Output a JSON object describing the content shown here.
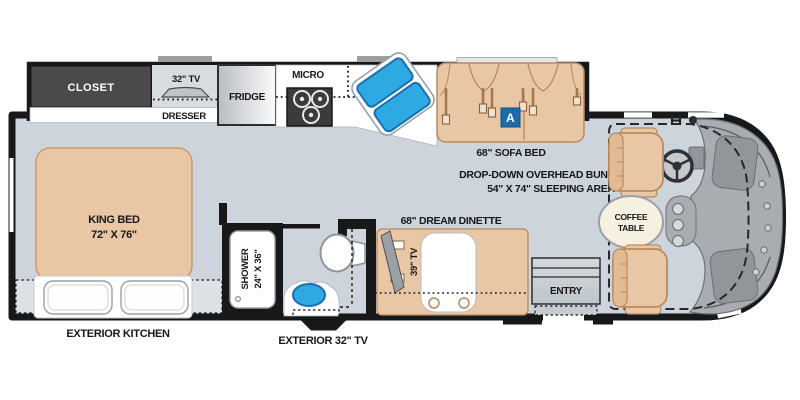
{
  "floorplan": {
    "labels": {
      "closet": "CLOSET",
      "tv32": "32\" TV",
      "dresser": "DRESSER",
      "fridge": "FRIDGE",
      "micro": "MICRO",
      "sofa_bed": "68\" SOFA BED",
      "sofa_badge": "A",
      "bunk_line1": "DROP-DOWN OVERHEAD BUNK",
      "bunk_line2": "54\" X 74\" SLEEPING AREA",
      "king_bed_line1": "KING BED",
      "king_bed_line2": "72\" X 76\"",
      "shower_line1": "SHOWER",
      "shower_line2": "24\" X 36\"",
      "tv39": "39\" TV",
      "dinette": "68\" DREAM DINETTE",
      "entry": "ENTRY",
      "coffee_line1": "COFFEE",
      "coffee_line2": "TABLE",
      "exterior_kitchen": "EXTERIOR KITCHEN",
      "exterior_tv": "EXTERIOR 32\" TV"
    },
    "colors": {
      "background": "#ffffff",
      "floor": "#cdd4dc",
      "wall": "#17181a",
      "furniture_tan": "#e9c6a4",
      "furniture_line": "#b98a5e",
      "closet_dark": "#4a4a4c",
      "counter_white": "#ffffff",
      "sink_blue": "#2fa9e2",
      "sink_blue_border": "#1b6fae",
      "badge_blue": "#1c6cab",
      "cab_gray": "#a9adb1",
      "cab_panel_gray": "#92969a",
      "slide_tab_gray": "#9b9fa2"
    },
    "icons": {
      "tv32": "tv-icon",
      "stove": "stove-burners-icon",
      "kitchen_sink": "double-sink-icon",
      "seatbelts": "seatbelt-icon",
      "toilet": "toilet-icon",
      "bath_sink": "oval-sink-icon",
      "steering": "steering-wheel-icon",
      "exterior_tv": "tv-icon",
      "tv39": "tv-icon"
    }
  }
}
